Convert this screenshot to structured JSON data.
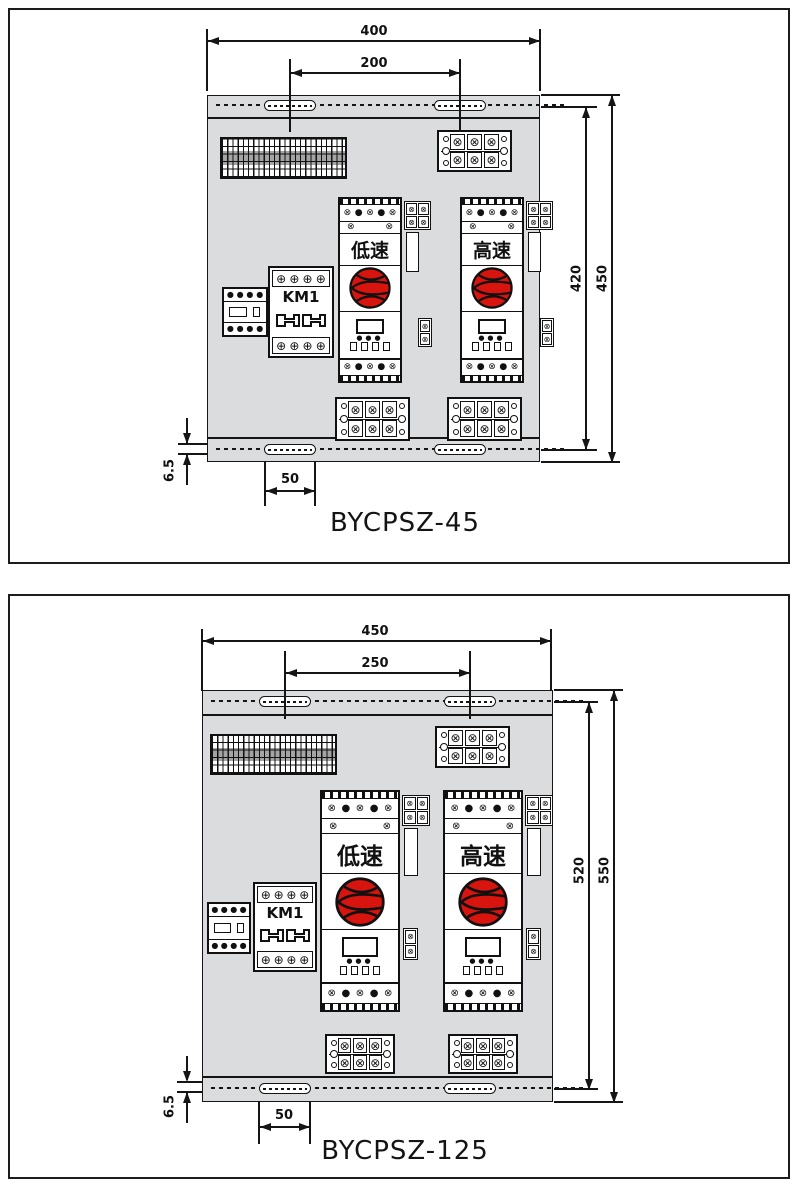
{
  "figures": [
    {
      "title": "BYCPSZ-45",
      "dimensions": {
        "overall_width": "400",
        "hole_spacing": "200",
        "inner_height": "420",
        "overall_height": "450",
        "flange_height": "6.5",
        "slot_length": "50"
      },
      "devices": [
        {
          "label": "低速"
        },
        {
          "label": "高速"
        }
      ],
      "contactor_label": "KM1"
    },
    {
      "title": "BYCPSZ-125",
      "dimensions": {
        "overall_width": "450",
        "hole_spacing": "250",
        "inner_height": "520",
        "overall_height": "550",
        "flange_height": "6.5",
        "slot_length": "50"
      },
      "devices": [
        {
          "label": "低速"
        },
        {
          "label": "高速"
        }
      ],
      "contactor_label": "KM1"
    }
  ],
  "colors": {
    "panel_gray": "#dbdcde",
    "line_black": "#151515",
    "knob_red": "#d8140e"
  }
}
